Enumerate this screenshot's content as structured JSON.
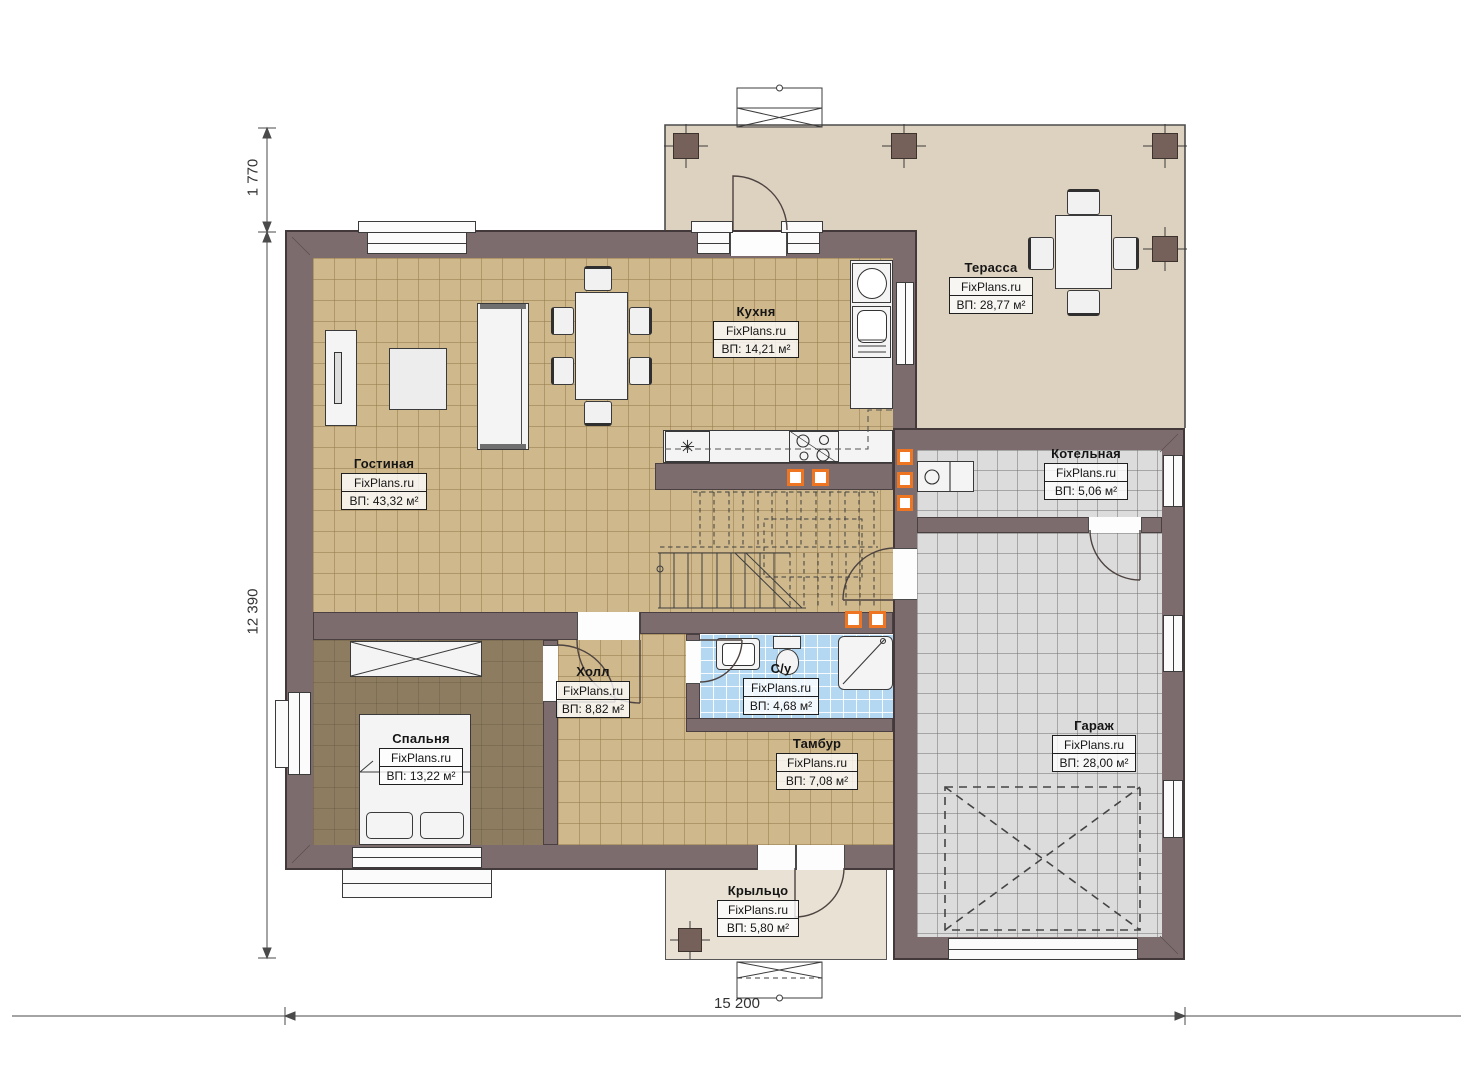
{
  "watermark": "FixPlans.ru",
  "rooms": {
    "living": {
      "name": "Гостиная",
      "area": "ВП: 43,32 м²"
    },
    "kitchen": {
      "name": "Кухня",
      "area": "ВП: 14,21 м²"
    },
    "terrace": {
      "name": "Терасса",
      "area": "ВП: 28,77 м²"
    },
    "boiler": {
      "name": "Котельная",
      "area": "ВП: 5,06 м²"
    },
    "garage": {
      "name": "Гараж",
      "area": "ВП: 28,00 м²"
    },
    "bedroom": {
      "name": "Спальня",
      "area": "ВП: 13,22 м²"
    },
    "hall": {
      "name": "Холл",
      "area": "ВП: 8,82 м²"
    },
    "bathroom": {
      "name": "С/у",
      "area": "ВП: 4,68 м²"
    },
    "vestibule": {
      "name": "Тамбур",
      "area": "ВП: 7,08 м²"
    },
    "porch": {
      "name": "Крыльцо",
      "area": "ВП: 5,80 м²"
    }
  },
  "dimensions": {
    "terrace_depth": "1 770",
    "house_depth": "12 390",
    "house_width": "15 200"
  },
  "icons": {
    "fridge_glyph": "✳"
  },
  "colors": {
    "wall": "#7d6c6e",
    "floor_tile": "#cfb88c",
    "floor_bedroom": "#8d7c5f",
    "floor_bath": "#b4d8f2",
    "floor_garage": "#dcdcdc",
    "terrace": "#ddd1c0",
    "porch": "#e9e2d4",
    "vent_accent": "#ee7522"
  }
}
